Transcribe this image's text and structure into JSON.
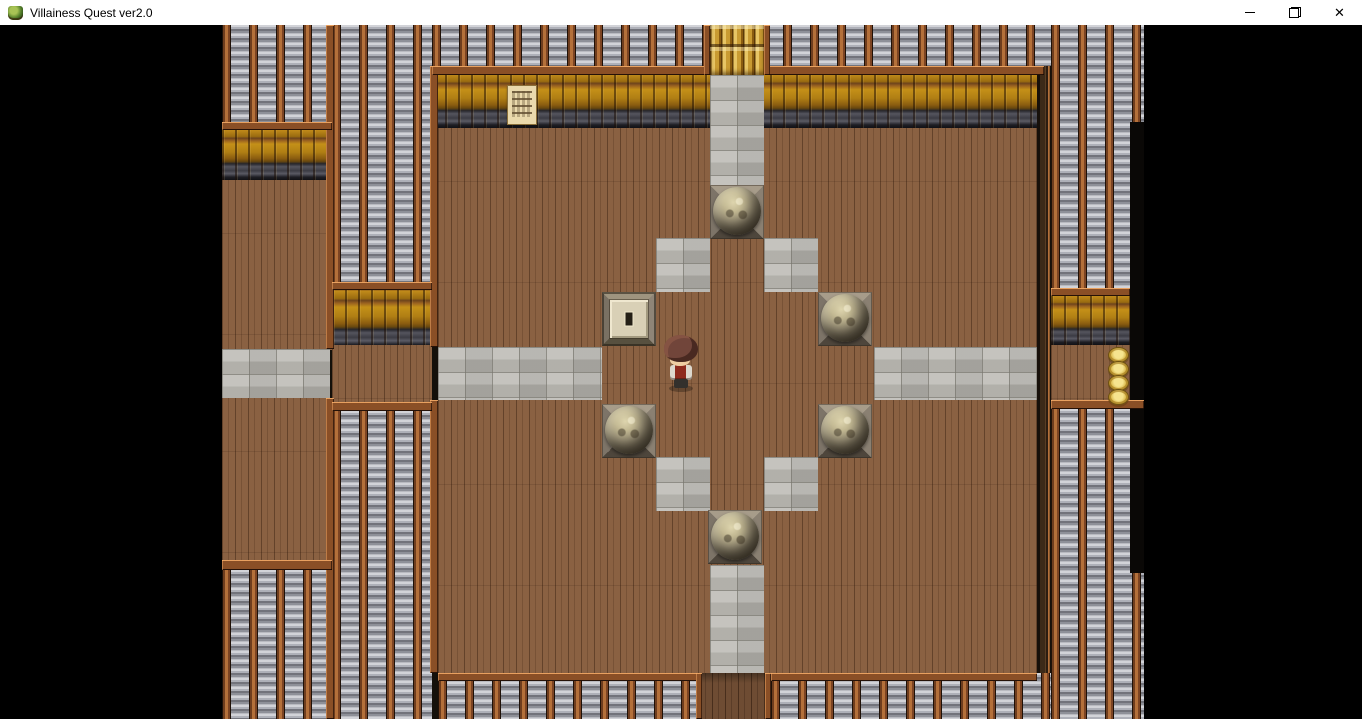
{
  "window": {
    "title": "Villainess Quest ver2.0",
    "controls": {
      "minimize": "minimize",
      "restore": "restore-down",
      "close_glyph": "✕"
    }
  },
  "game": {
    "viewport": {
      "x": 222,
      "y": 25,
      "w": 922,
      "h": 694
    },
    "palette": {
      "floor_wood": "#8a6142",
      "stone_path": "#b5b3ad",
      "roof_slat_light": "#d2d3d8",
      "roof_slat_dark": "#72737b",
      "roof_beam": "#b4703a",
      "wall_gold": "#c08a1a",
      "trim_dark": "#3c3c44",
      "frame_brown": "#8a4f26",
      "boulder_light": "#ded5ae",
      "boulder_dark": "#403a2e",
      "coin_gold": "#d9b84a",
      "character_hair": "#71453a",
      "character_vest": "#8e2a1e",
      "letterbox": "#000000"
    },
    "regions": [
      {
        "t": "roof",
        "x": 0,
        "y": 0,
        "w": 110,
        "h": 97
      },
      {
        "t": "roof",
        "x": 110,
        "y": 0,
        "w": 100,
        "h": 257
      },
      {
        "t": "roof",
        "x": 210,
        "y": 0,
        "w": 712,
        "h": 41
      },
      {
        "t": "roof",
        "x": 829,
        "y": 0,
        "w": 93,
        "h": 263
      },
      {
        "t": "wall",
        "x": 0,
        "y": 97,
        "w": 110,
        "h": 58
      },
      {
        "t": "floor",
        "x": 0,
        "y": 155,
        "w": 110,
        "h": 170
      },
      {
        "t": "wall",
        "x": 110,
        "y": 257,
        "w": 100,
        "h": 66
      },
      {
        "t": "floor",
        "x": 110,
        "y": 320,
        "w": 100,
        "h": 57
      },
      {
        "t": "wall",
        "x": 210,
        "y": 41,
        "w": 612,
        "h": 62
      },
      {
        "t": "floor",
        "x": 216,
        "y": 103,
        "w": 599,
        "h": 545
      },
      {
        "t": "wall",
        "x": 829,
        "y": 263,
        "w": 79,
        "h": 57
      },
      {
        "t": "floor",
        "x": 829,
        "y": 320,
        "w": 79,
        "h": 56
      },
      {
        "t": "floor",
        "x": 0,
        "y": 373,
        "w": 110,
        "h": 162
      },
      {
        "t": "stone",
        "x": 0,
        "y": 324,
        "w": 108,
        "h": 49
      },
      {
        "t": "stone",
        "x": 216,
        "y": 322,
        "w": 164,
        "h": 53
      },
      {
        "t": "stone",
        "x": 652,
        "y": 322,
        "w": 163,
        "h": 53
      },
      {
        "t": "stone",
        "x": 488,
        "y": 50,
        "w": 54,
        "h": 110
      },
      {
        "t": "stone",
        "x": 488,
        "y": 540,
        "w": 54,
        "h": 108
      },
      {
        "t": "stone",
        "x": 434,
        "y": 213,
        "w": 54,
        "h": 54
      },
      {
        "t": "stone",
        "x": 542,
        "y": 213,
        "w": 54,
        "h": 54
      },
      {
        "t": "stone",
        "x": 434,
        "y": 432,
        "w": 54,
        "h": 54
      },
      {
        "t": "stone",
        "x": 542,
        "y": 432,
        "w": 54,
        "h": 54
      },
      {
        "t": "roof",
        "x": 110,
        "y": 377,
        "w": 100,
        "h": 317
      },
      {
        "t": "roof",
        "x": 0,
        "y": 545,
        "w": 110,
        "h": 149
      },
      {
        "t": "roof",
        "x": 216,
        "y": 648,
        "w": 261,
        "h": 46
      },
      {
        "t": "wood2",
        "x": 477,
        "y": 648,
        "w": 72,
        "h": 46
      },
      {
        "t": "roof",
        "x": 549,
        "y": 648,
        "w": 280,
        "h": 46
      },
      {
        "t": "roof",
        "x": 829,
        "y": 375,
        "w": 93,
        "h": 319
      },
      {
        "t": "darkwall",
        "x": 815,
        "y": 41,
        "w": 14,
        "h": 607
      },
      {
        "t": "dark",
        "x": 908,
        "y": 97,
        "w": 14,
        "h": 451
      },
      {
        "t": "frame",
        "x": 104,
        "y": 0,
        "w": 8,
        "h": 324
      },
      {
        "t": "frame",
        "x": 104,
        "y": 373,
        "w": 8,
        "h": 321
      },
      {
        "t": "frame",
        "x": 208,
        "y": 41,
        "w": 8,
        "h": 281
      },
      {
        "t": "frame",
        "x": 208,
        "y": 375,
        "w": 8,
        "h": 273
      },
      {
        "t": "frame",
        "x": 210,
        "y": 41,
        "w": 278,
        "h": 9
      },
      {
        "t": "frame",
        "x": 542,
        "y": 41,
        "w": 280,
        "h": 9
      },
      {
        "t": "frame",
        "x": 0,
        "y": 97,
        "w": 110,
        "h": 8
      },
      {
        "t": "frame",
        "x": 110,
        "y": 257,
        "w": 100,
        "h": 8
      },
      {
        "t": "frame",
        "x": 829,
        "y": 263,
        "w": 79,
        "h": 8
      },
      {
        "t": "frame",
        "x": 0,
        "y": 535,
        "w": 110,
        "h": 10
      },
      {
        "t": "frame",
        "x": 110,
        "y": 377,
        "w": 100,
        "h": 9
      },
      {
        "t": "frame",
        "x": 216,
        "y": 648,
        "w": 261,
        "h": 8
      },
      {
        "t": "frame",
        "x": 549,
        "y": 648,
        "w": 266,
        "h": 8
      },
      {
        "t": "frame",
        "x": 829,
        "y": 375,
        "w": 93,
        "h": 9
      },
      {
        "t": "frame",
        "x": 474,
        "y": 648,
        "w": 6,
        "h": 46
      },
      {
        "t": "frame",
        "x": 543,
        "y": 648,
        "w": 6,
        "h": 46
      },
      {
        "t": "frame",
        "x": 482,
        "y": 0,
        "w": 6,
        "h": 50
      },
      {
        "t": "frame",
        "x": 542,
        "y": 0,
        "w": 6,
        "h": 50
      }
    ],
    "boulders": [
      {
        "x": 488,
        "y": 160
      },
      {
        "x": 596,
        "y": 267
      },
      {
        "x": 380,
        "y": 379
      },
      {
        "x": 596,
        "y": 379
      },
      {
        "x": 486,
        "y": 485
      }
    ],
    "floor_switch": {
      "x": 380,
      "y": 267,
      "w": 54,
      "h": 54
    },
    "sign": {
      "x": 285,
      "y": 60,
      "w": 28,
      "h": 38
    },
    "log_pile": {
      "x": 488,
      "y": 0,
      "w": 54,
      "h": 50
    },
    "coin_stack": {
      "x": 886,
      "y": 322,
      "count": 4,
      "dy": 14
    },
    "character": {
      "x": 440,
      "y": 310,
      "facing": "down"
    }
  }
}
